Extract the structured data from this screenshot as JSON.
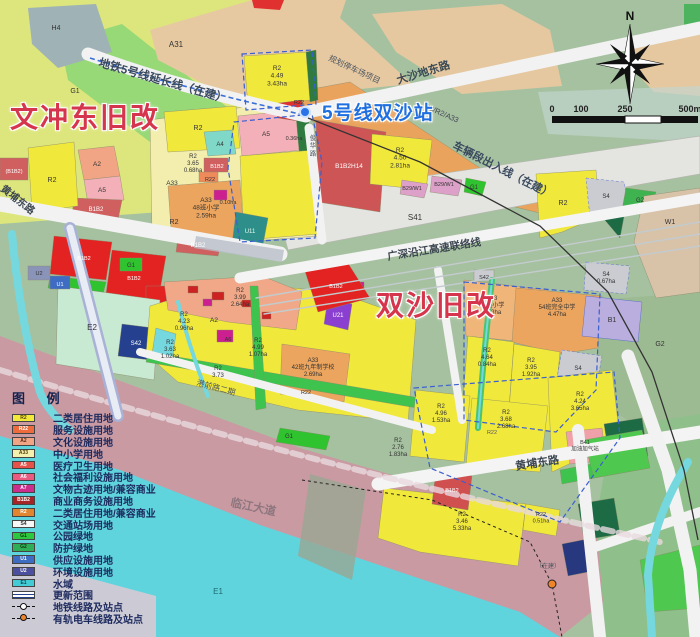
{
  "annotations": {
    "wenchong_label": "文冲东旧改",
    "shuangsha_label": "双沙旧改",
    "station_label": "5号线双沙站"
  },
  "compass": {
    "north": "N"
  },
  "scalebar": {
    "ticks": [
      "0",
      "100",
      "250",
      "500m"
    ]
  },
  "legend": {
    "title": "图 例",
    "items": [
      {
        "type": "swatch",
        "code": "R2",
        "label": "二类居住用地",
        "color": "#f2e93a",
        "text_color": "#55430e"
      },
      {
        "type": "swatch",
        "code": "R22",
        "label": "服务设施用地",
        "color": "#ee6b3e",
        "text_color": "#fff"
      },
      {
        "type": "swatch",
        "code": "A2",
        "label": "文化设施用地",
        "color": "#f2a585",
        "text_color": "#5a2a18"
      },
      {
        "type": "swatch",
        "code": "A33",
        "label": "中小学用地",
        "color": "#f6f0ae",
        "text_color": "#55430e"
      },
      {
        "type": "swatch",
        "code": "A5",
        "label": "医疗卫生用地",
        "color": "#e4524a",
        "text_color": "#fff"
      },
      {
        "type": "swatch",
        "code": "A6",
        "label": "社会福利设施用地",
        "color": "#ea5b80",
        "text_color": "#fff"
      },
      {
        "type": "swatch",
        "code": "A7",
        "label": "文物古迹用地/兼容商业",
        "color": "#cb2f8e",
        "text_color": "#fff"
      },
      {
        "type": "swatch",
        "code": "B1B2",
        "label": "商业商务设施用地",
        "color": "#a42626",
        "text_color": "#fff"
      },
      {
        "type": "swatch",
        "code": "R2",
        "label": "二类居住用地/兼容商业",
        "color": "#e1862e",
        "text_color": "#fff"
      },
      {
        "type": "swatch",
        "code": "S4",
        "label": "交通站场用地",
        "color": "#f7f7f7",
        "text_color": "#333"
      },
      {
        "type": "swatch",
        "code": "G1",
        "label": "公园绿地",
        "color": "#2ec83e",
        "text_color": "#0c3a10"
      },
      {
        "type": "swatch",
        "code": "G2",
        "label": "防护绿地",
        "color": "#2fae57",
        "text_color": "#0c3a10"
      },
      {
        "type": "swatch",
        "code": "U1",
        "label": "供应设施用地",
        "color": "#3e6cc3",
        "text_color": "#fff"
      },
      {
        "type": "swatch",
        "code": "U2",
        "label": "环境设施用地",
        "color": "#4c4f9d",
        "text_color": "#fff"
      },
      {
        "type": "swatch",
        "code": "E1",
        "label": "水域",
        "color": "#44ccd6",
        "text_color": "#0c4a50"
      },
      {
        "type": "range",
        "code": "",
        "label": "更新范围"
      },
      {
        "type": "metro",
        "code": "",
        "label": "地铁线路及站点"
      },
      {
        "type": "tram",
        "code": "",
        "label": "有轨电车线路及站点"
      }
    ]
  },
  "map_text": {
    "labels": [
      {
        "l": [
          "H4"
        ],
        "x": 56,
        "y": 30,
        "s": 7
      },
      {
        "l": [
          "A31"
        ],
        "x": 176,
        "y": 47,
        "s": 8
      },
      {
        "l": [
          "G1"
        ],
        "x": 75,
        "y": 93,
        "s": 7
      },
      {
        "l": [
          "R2",
          "4.49",
          "3.43ha"
        ],
        "x": 277,
        "y": 70,
        "s": 6.5
      },
      {
        "l": [
          "R22"
        ],
        "x": 299,
        "y": 104,
        "s": 5.5
      },
      {
        "l": [
          "(B1B2)"
        ],
        "x": 14,
        "y": 173,
        "s": 5.5,
        "c": "#fff"
      },
      {
        "l": [
          "R2"
        ],
        "x": 52,
        "y": 182,
        "s": 7
      },
      {
        "l": [
          "A2"
        ],
        "x": 97,
        "y": 166,
        "s": 6.5
      },
      {
        "l": [
          "A5"
        ],
        "x": 102,
        "y": 192,
        "s": 6.5
      },
      {
        "l": [
          "B1B2"
        ],
        "x": 96,
        "y": 211,
        "s": 6,
        "c": "#fff"
      },
      {
        "l": [
          "R2"
        ],
        "x": 198,
        "y": 130,
        "s": 7
      },
      {
        "l": [
          "A4"
        ],
        "x": 220,
        "y": 146,
        "s": 6
      },
      {
        "l": [
          "A5"
        ],
        "x": 266,
        "y": 136,
        "s": 6.5
      },
      {
        "l": [
          "0.36ha"
        ],
        "x": 294,
        "y": 140,
        "s": 5.5
      },
      {
        "l": [
          "R2",
          "3.65",
          "0.68ha"
        ],
        "x": 193,
        "y": 158,
        "s": 6
      },
      {
        "l": [
          "B1B2"
        ],
        "x": 217,
        "y": 168,
        "s": 5.5,
        "c": "#fff"
      },
      {
        "l": [
          "R22"
        ],
        "x": 210,
        "y": 181,
        "s": 5.5
      },
      {
        "l": [
          "A33"
        ],
        "x": 172,
        "y": 185,
        "s": 6.5
      },
      {
        "l": [
          "A33",
          "48班小学",
          "2.59ha"
        ],
        "x": 206,
        "y": 202,
        "s": 6.5
      },
      {
        "l": [
          "R2"
        ],
        "x": 174,
        "y": 224,
        "s": 7
      },
      {
        "l": [
          "0.10ha"
        ],
        "x": 228,
        "y": 204,
        "s": 5.5
      },
      {
        "l": [
          "B1B2"
        ],
        "x": 198,
        "y": 247,
        "s": 6,
        "c": "#fff"
      },
      {
        "l": [
          "U11"
        ],
        "x": 250,
        "y": 233,
        "s": 6,
        "c": "#e8f8f0"
      },
      {
        "l": [
          "B1B2H14"
        ],
        "x": 349,
        "y": 168,
        "s": 6.5,
        "c": "#fff"
      },
      {
        "l": [
          "R2",
          "4.50",
          "2.81ha"
        ],
        "x": 400,
        "y": 152,
        "s": 6.5
      },
      {
        "l": [
          "B29/W1"
        ],
        "x": 412,
        "y": 190,
        "s": 5.5
      },
      {
        "l": [
          "B29/W1"
        ],
        "x": 444,
        "y": 186,
        "s": 5.5
      },
      {
        "l": [
          "G1"
        ],
        "x": 474,
        "y": 189,
        "s": 6
      },
      {
        "l": [
          "S41"
        ],
        "x": 415,
        "y": 220,
        "s": 8
      },
      {
        "l": [
          "R2"
        ],
        "x": 563,
        "y": 205,
        "s": 7
      },
      {
        "l": [
          "S4"
        ],
        "x": 606,
        "y": 198,
        "s": 6
      },
      {
        "l": [
          "G2"
        ],
        "x": 640,
        "y": 202,
        "s": 6
      },
      {
        "l": [
          "W1"
        ],
        "x": 670,
        "y": 224,
        "s": 7
      },
      {
        "l": [
          "S4",
          "0.67ha"
        ],
        "x": 606,
        "y": 276,
        "s": 6
      },
      {
        "l": [
          "S42"
        ],
        "x": 484,
        "y": 279,
        "s": 5.5
      },
      {
        "l": [
          "A33",
          "24班小学",
          "1.53ha"
        ],
        "x": 492,
        "y": 300,
        "s": 6
      },
      {
        "l": [
          "A33",
          "54班完全中学",
          "4.47ha"
        ],
        "x": 557,
        "y": 302,
        "s": 6
      },
      {
        "l": [
          "B1"
        ],
        "x": 612,
        "y": 322,
        "s": 7
      },
      {
        "l": [
          "G2"
        ],
        "x": 660,
        "y": 346,
        "s": 7
      },
      {
        "l": [
          "R2",
          "4.64",
          "0.84ha"
        ],
        "x": 487,
        "y": 352,
        "s": 6
      },
      {
        "l": [
          "R2",
          "3.95",
          "1.92ha"
        ],
        "x": 531,
        "y": 362,
        "s": 6
      },
      {
        "l": [
          "S4"
        ],
        "x": 578,
        "y": 370,
        "s": 6
      },
      {
        "l": [
          "R2",
          "3.99",
          "2.64ha"
        ],
        "x": 240,
        "y": 292,
        "s": 6
      },
      {
        "l": [
          "A2"
        ],
        "x": 214,
        "y": 322,
        "s": 6.5
      },
      {
        "l": [
          "R2",
          "4.23",
          "0.96ha"
        ],
        "x": 184,
        "y": 316,
        "s": 6
      },
      {
        "l": [
          "R2",
          "3.63",
          "1.02ha"
        ],
        "x": 170,
        "y": 344,
        "s": 6
      },
      {
        "l": [
          "A6"
        ],
        "x": 228,
        "y": 341,
        "s": 5.5
      },
      {
        "l": [
          "R2",
          "4.99",
          "1.07ha"
        ],
        "x": 258,
        "y": 342,
        "s": 6
      },
      {
        "l": [
          "R2",
          "3.73"
        ],
        "x": 218,
        "y": 370,
        "s": 6
      },
      {
        "l": [
          "A33",
          "42班九年制学校",
          "2.69ha"
        ],
        "x": 313,
        "y": 362,
        "s": 6
      },
      {
        "l": [
          "R22"
        ],
        "x": 306,
        "y": 394,
        "s": 5.5
      },
      {
        "l": [
          "U21"
        ],
        "x": 338,
        "y": 317,
        "s": 6,
        "c": "#fff"
      },
      {
        "l": [
          "R2",
          "4.96",
          "1.53ha"
        ],
        "x": 441,
        "y": 408,
        "s": 6
      },
      {
        "l": [
          "R2",
          "3.68",
          "2.68ha"
        ],
        "x": 506,
        "y": 414,
        "s": 6
      },
      {
        "l": [
          "R22"
        ],
        "x": 492,
        "y": 434,
        "s": 5.5,
        "c": "#556"
      },
      {
        "l": [
          "R2",
          "4.24",
          "3.65ha"
        ],
        "x": 580,
        "y": 396,
        "s": 6
      },
      {
        "l": [
          "R2",
          "2.76",
          "1.83ha"
        ],
        "x": 398,
        "y": 442,
        "s": 6
      },
      {
        "l": [
          "B41",
          "加油加气站"
        ],
        "x": 585,
        "y": 444,
        "s": 5.5
      },
      {
        "l": [
          "B1B2"
        ],
        "x": 452,
        "y": 492,
        "s": 5.5,
        "c": "#fff"
      },
      {
        "l": [
          "R2",
          "3.46",
          "5.33ha"
        ],
        "x": 462,
        "y": 516,
        "s": 6
      },
      {
        "l": [
          "R22",
          "0.51ha"
        ],
        "x": 541,
        "y": 516,
        "s": 5.5
      },
      {
        "l": [
          "E2"
        ],
        "x": 92,
        "y": 330,
        "s": 8
      },
      {
        "l": [
          "U2"
        ],
        "x": 39,
        "y": 275,
        "s": 5.5
      },
      {
        "l": [
          "U1"
        ],
        "x": 60,
        "y": 286,
        "s": 5.5,
        "c": "#fff"
      },
      {
        "l": [
          "G1"
        ],
        "x": 131,
        "y": 267,
        "s": 6
      },
      {
        "l": [
          "S42"
        ],
        "x": 136,
        "y": 345,
        "s": 6,
        "c": "#fff"
      },
      {
        "l": [
          "E1"
        ],
        "x": 218,
        "y": 594,
        "s": 8,
        "c": "#1f6b73"
      },
      {
        "l": [
          "G1"
        ],
        "x": 289,
        "y": 438,
        "s": 6
      },
      {
        "l": [
          "B1B2"
        ],
        "x": 84,
        "y": 260,
        "s": 5.5,
        "c": "#fff"
      },
      {
        "l": [
          "B1B2"
        ],
        "x": 134,
        "y": 280,
        "s": 5.5,
        "c": "#fff"
      },
      {
        "l": [
          "B1B2"
        ],
        "x": 336,
        "y": 288,
        "s": 5.5,
        "c": "#fff"
      },
      {
        "l": [
          "地铁5号线延长线（在建）"
        ],
        "x": 98,
        "y": 66,
        "s": 11.5,
        "r": 16,
        "a": "start",
        "c": "#3a4a5e",
        "w": 700
      },
      {
        "l": [
          "大沙地东路"
        ],
        "x": 398,
        "y": 84,
        "s": 11,
        "r": -17,
        "a": "start",
        "c": "#3c4a55",
        "w": 700
      },
      {
        "l": [
          "规划停车场项目"
        ],
        "x": 328,
        "y": 60,
        "s": 8,
        "r": 25,
        "a": "start",
        "c": "#4a5560"
      },
      {
        "l": [
          "车辆段出入线（在建）"
        ],
        "x": 452,
        "y": 148,
        "s": 11,
        "r": 27,
        "a": "start",
        "c": "#3a4a5e",
        "w": 700
      },
      {
        "l": [
          "B3/R2/A33"
        ],
        "x": 424,
        "y": 108,
        "s": 7.5,
        "r": 24,
        "a": "start",
        "c": "#445"
      },
      {
        "l": [
          "广深沿江高速联络线"
        ],
        "x": 388,
        "y": 260,
        "s": 10.5,
        "r": -9,
        "a": "start",
        "c": "#3c4650",
        "w": 700
      },
      {
        "l": [
          "黄埔东路"
        ],
        "x": 0,
        "y": 190,
        "s": 10,
        "r": 38,
        "a": "start",
        "c": "#3c4650",
        "w": 700
      },
      {
        "l": [
          "黄埔东路"
        ],
        "x": 516,
        "y": 470,
        "s": 11,
        "r": -9,
        "a": "start",
        "c": "#3c4650",
        "w": 700
      },
      {
        "l": [
          "临江大道"
        ],
        "x": 230,
        "y": 506,
        "s": 11.5,
        "r": 12,
        "a": "start",
        "c": "#8d767f",
        "w": 700
      },
      {
        "l": [
          "港前路二期"
        ],
        "x": 196,
        "y": 385,
        "s": 8,
        "r": 15,
        "a": "start",
        "c": "#4a5560"
      },
      {
        "l": [
          "俊",
          "华",
          "路"
        ],
        "x": 313,
        "y": 140,
        "s": 6.5,
        "c": "#4a5560"
      },
      {
        "l": [
          "（在建）"
        ],
        "x": 548,
        "y": 568,
        "s": 6,
        "c": "#4a5560"
      }
    ]
  }
}
